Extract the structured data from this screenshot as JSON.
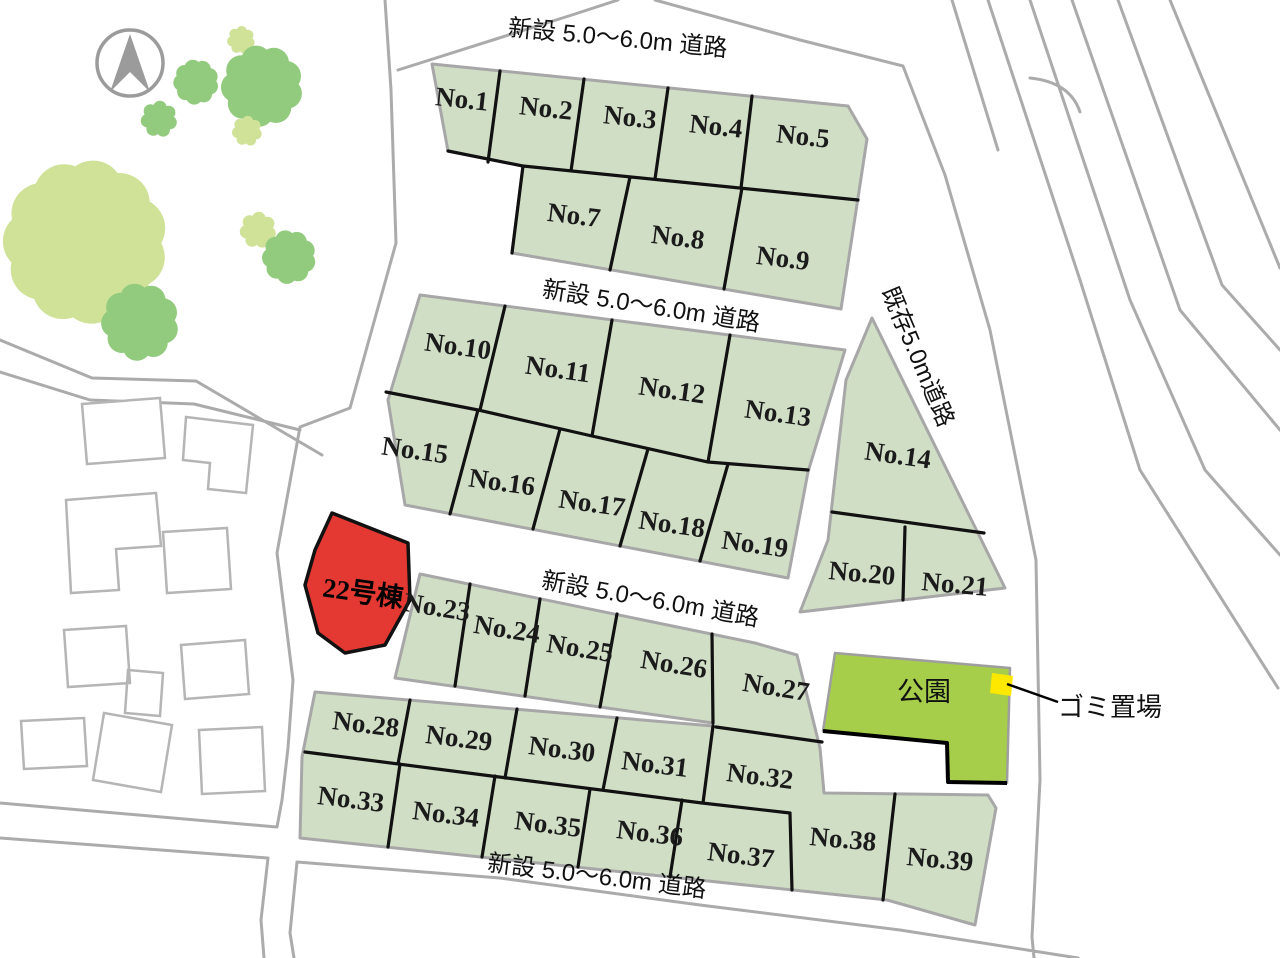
{
  "map_type": "residential-subdivision-lot-map",
  "roads": {
    "new_label": "新設 5.0〜6.0m 道路",
    "existing_label": "既存5.0m道路"
  },
  "special": {
    "building_22": "22号棟",
    "park": "公園",
    "garbage": "ゴミ置場"
  },
  "icons": {
    "compass": "north-arrow"
  },
  "colors": {
    "lot": "#d0dec6",
    "park": "#a6ce4b",
    "building22": "#e33932",
    "garbage": "#ffe800",
    "tree_light": "#cfe298",
    "tree_green": "#92cb7d",
    "road_line": "#ababab",
    "boundary": "#111111"
  },
  "lots": [
    {
      "label": "No.1"
    },
    {
      "label": "No.2"
    },
    {
      "label": "No.3"
    },
    {
      "label": "No.4"
    },
    {
      "label": "No.5"
    },
    {
      "label": "No.7"
    },
    {
      "label": "No.8"
    },
    {
      "label": "No.9"
    },
    {
      "label": "No.10"
    },
    {
      "label": "No.11"
    },
    {
      "label": "No.12"
    },
    {
      "label": "No.13"
    },
    {
      "label": "No.14"
    },
    {
      "label": "No.15"
    },
    {
      "label": "No.16"
    },
    {
      "label": "No.17"
    },
    {
      "label": "No.18"
    },
    {
      "label": "No.19"
    },
    {
      "label": "No.20"
    },
    {
      "label": "No.21"
    },
    {
      "label": "No.23"
    },
    {
      "label": "No.24"
    },
    {
      "label": "No.25"
    },
    {
      "label": "No.26"
    },
    {
      "label": "No.27"
    },
    {
      "label": "No.28"
    },
    {
      "label": "No.29"
    },
    {
      "label": "No.30"
    },
    {
      "label": "No.31"
    },
    {
      "label": "No.32"
    },
    {
      "label": "No.33"
    },
    {
      "label": "No.34"
    },
    {
      "label": "No.35"
    },
    {
      "label": "No.36"
    },
    {
      "label": "No.37"
    },
    {
      "label": "No.38"
    },
    {
      "label": "No.39"
    }
  ]
}
